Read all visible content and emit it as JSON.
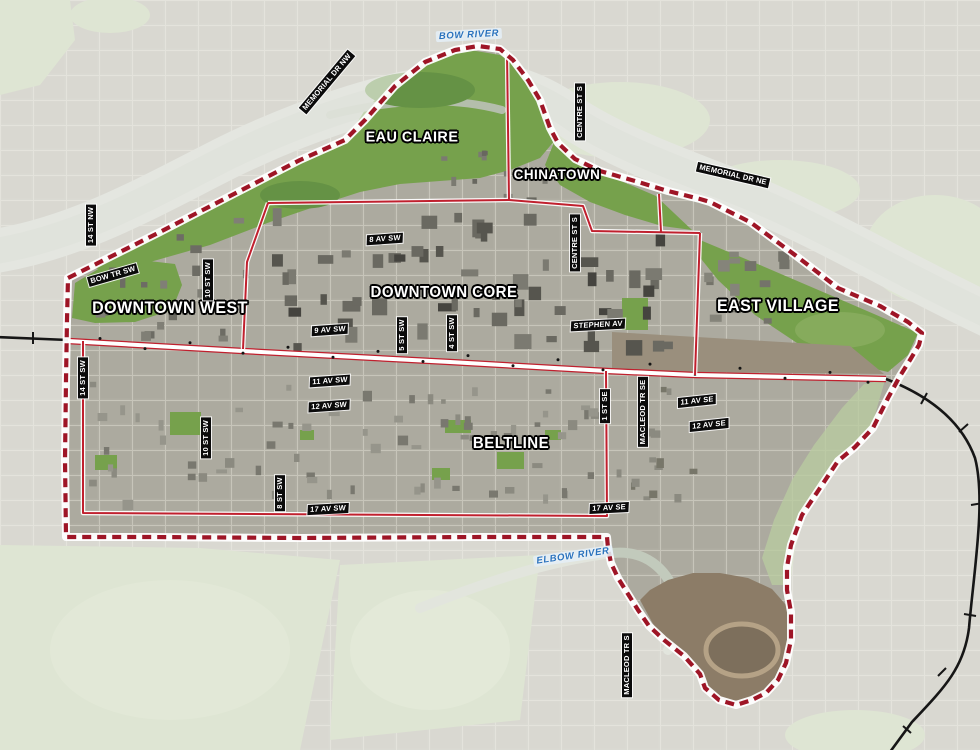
{
  "map": {
    "region_labels": [
      {
        "text": "EAU CLAIRE"
      },
      {
        "text": "CHINATOWN"
      },
      {
        "text": "DOWNTOWN WEST"
      },
      {
        "text": "DOWNTOWN CORE"
      },
      {
        "text": "EAST VILLAGE"
      },
      {
        "text": "BELTLINE"
      }
    ],
    "river_labels": [
      {
        "text": "BOW RIVER"
      },
      {
        "text": "ELBOW RIVER"
      }
    ],
    "street_labels": [
      {
        "text": "MEMORIAL DR NW"
      },
      {
        "text": "14 ST NW"
      },
      {
        "text": "CENTRE ST S"
      },
      {
        "text": "MEMORIAL DR NE"
      },
      {
        "text": "BOW TR SW"
      },
      {
        "text": "10 ST SW"
      },
      {
        "text": "8 AV SW"
      },
      {
        "text": "CENTRE ST S"
      },
      {
        "text": "9 AV SW"
      },
      {
        "text": "5 ST SW"
      },
      {
        "text": "4 ST SW"
      },
      {
        "text": "STEPHEN AV"
      },
      {
        "text": "14 ST SW"
      },
      {
        "text": "11 AV SW"
      },
      {
        "text": "12 AV SW"
      },
      {
        "text": "1 ST SE"
      },
      {
        "text": "MACLEOD TR SE"
      },
      {
        "text": "11 AV SE"
      },
      {
        "text": "12 AV SE"
      },
      {
        "text": "10 ST SW"
      },
      {
        "text": "8 ST SW"
      },
      {
        "text": "17 AV SW"
      },
      {
        "text": "17 AV SE"
      },
      {
        "text": "MACLEOD TR S"
      }
    ],
    "colors": {
      "boundary_dashed": "#9e1526",
      "district_line": "#c0202e",
      "railway": "#161616",
      "river_label": "#2a72bd",
      "park_green": "#76a14c",
      "water": "#c7ccc2"
    }
  }
}
